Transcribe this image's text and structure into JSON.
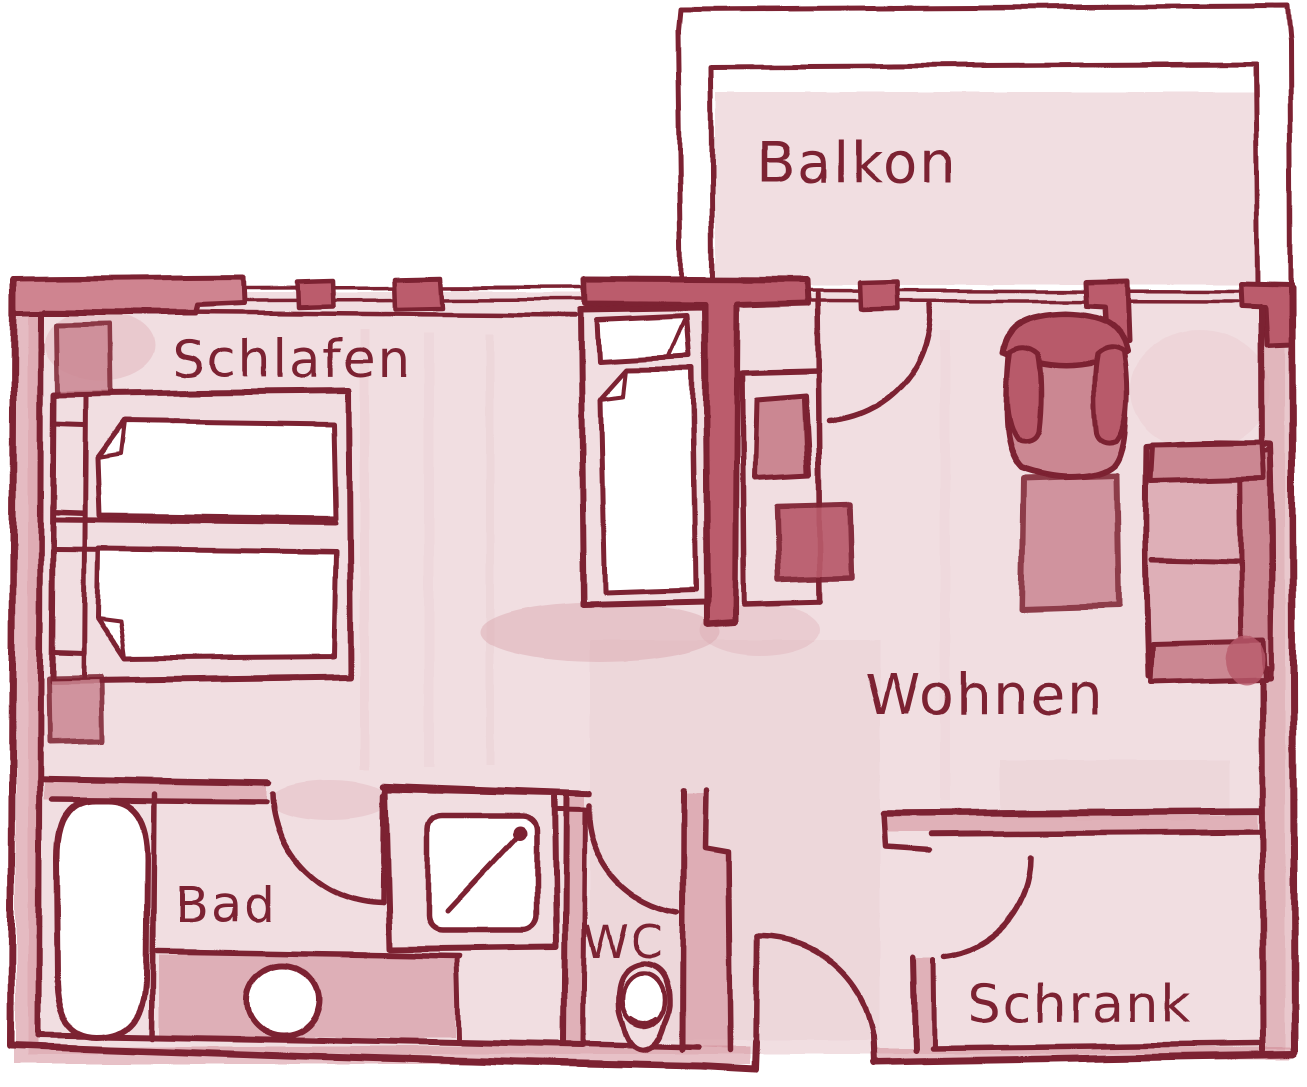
{
  "document": {
    "type": "apartment floor plan",
    "style": "hand-drawn watercolor sketch",
    "language": "de"
  },
  "rooms": {
    "balkon": {
      "label": "Balkon"
    },
    "schlafen": {
      "label": "Schlafen"
    },
    "wohnen": {
      "label": "Wohnen"
    },
    "bad": {
      "label": "Bad"
    },
    "wc": {
      "label": "WC"
    },
    "schrank": {
      "label": "Schrank"
    }
  },
  "furniture": {
    "schlafen": [
      "double-bed",
      "nightstand",
      "nightstand",
      "single-bed"
    ],
    "wohnen": [
      "tv-sideboard",
      "tv",
      "side-table",
      "armchair",
      "coffee-table",
      "sofa"
    ],
    "bad": [
      "bathtub",
      "shower",
      "washbasin-counter",
      "sink"
    ],
    "wc": [
      "toilet"
    ]
  },
  "doors": [
    "entrance-door",
    "balcony-door",
    "bad-door",
    "wc-door",
    "schrank-door"
  ],
  "windows": [
    "schlafen-window",
    "wohnen-balcony-window"
  ],
  "colors": {
    "line": "#7c2030",
    "wall_fill": "#cf8490",
    "wall_fill_dark": "#bb5c6c",
    "wash_light": "#f1dee1",
    "wash_mid": "#d9a3ad",
    "furn_mid": "#cb8792",
    "furn_dark": "#b85a6a",
    "sofa_seat": "#deafb7",
    "paper": "#ffffff"
  }
}
